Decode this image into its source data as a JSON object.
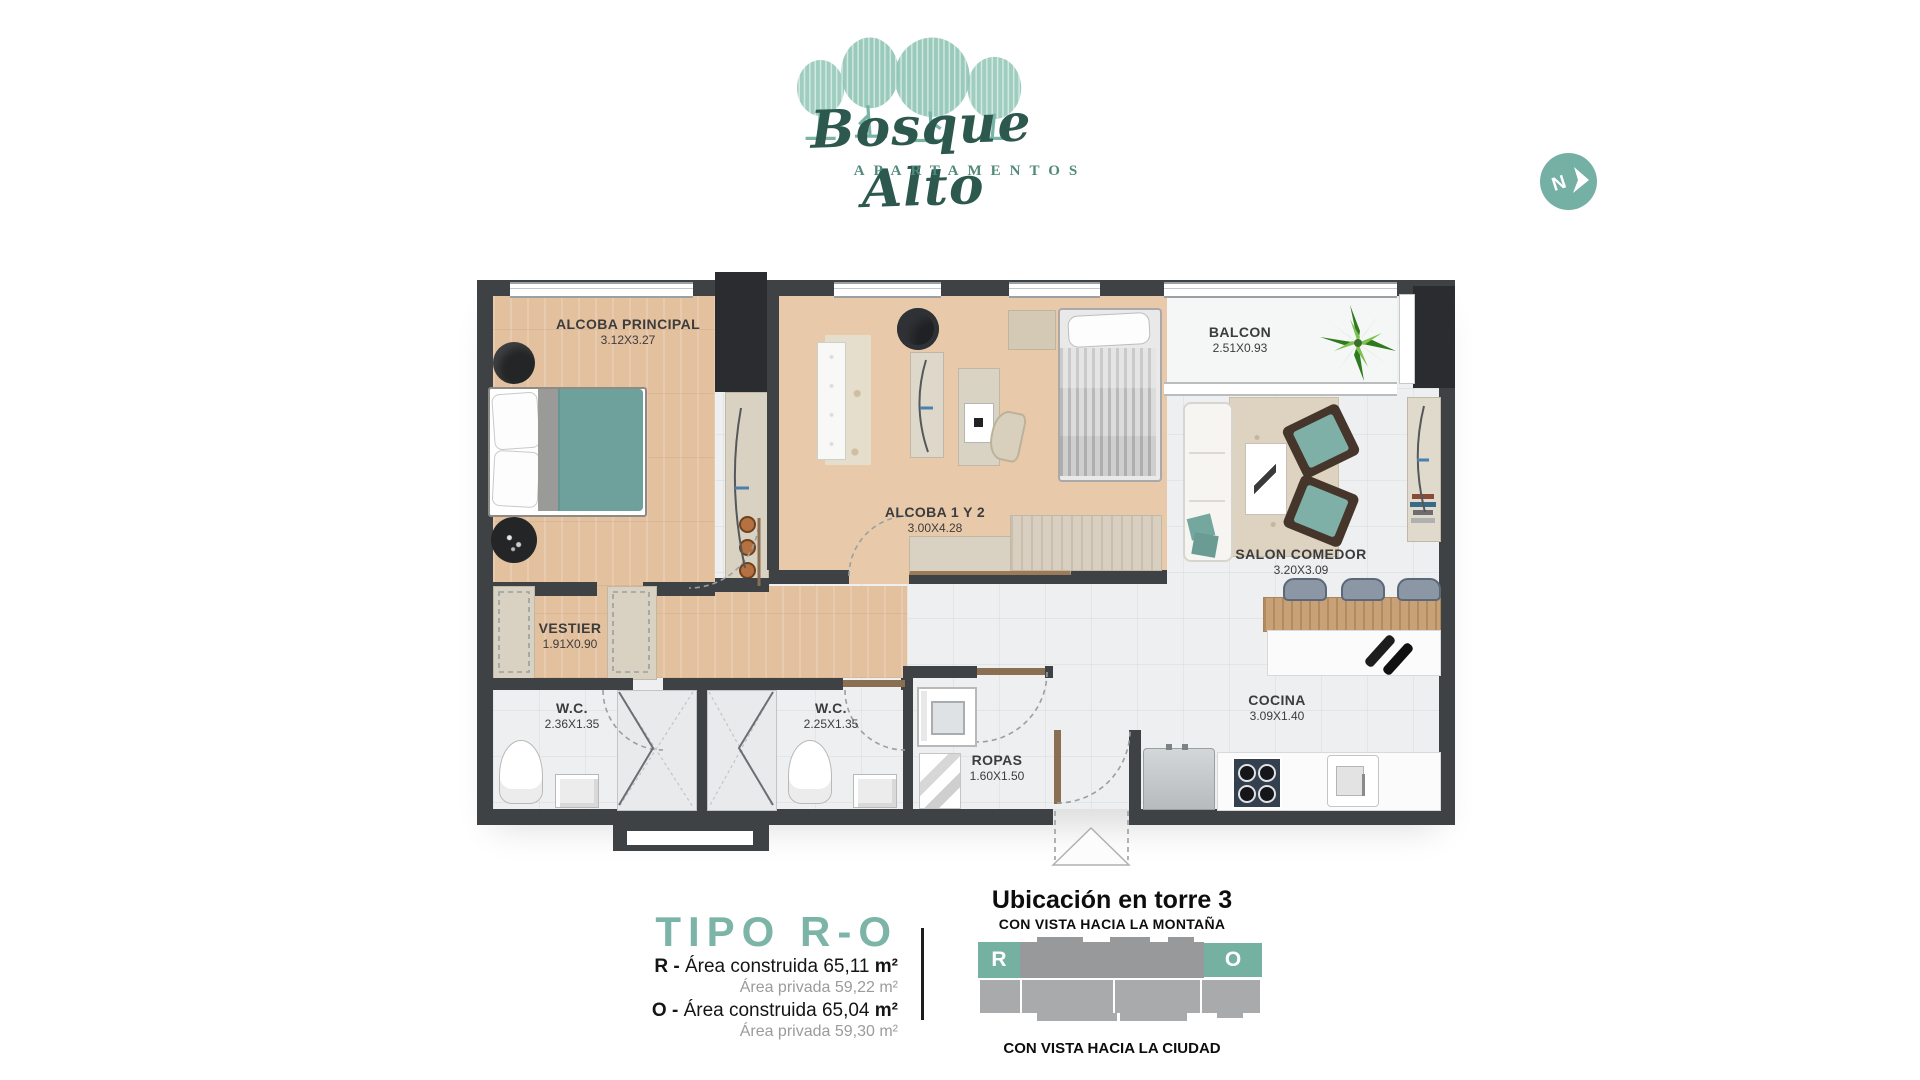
{
  "logo": {
    "title": "Bosque Alto",
    "subtitle": "APARTAMENTOS"
  },
  "compass": {
    "label": "N"
  },
  "plan": {
    "rooms": [
      {
        "name": "ALCOBA PRINCIPAL",
        "dims": "3.12X3.27"
      },
      {
        "name": "ALCOBA 1 Y 2",
        "dims": "3.00X4.28"
      },
      {
        "name": "BALCON",
        "dims": "2.51X0.93"
      },
      {
        "name": "SALON COMEDOR",
        "dims": "3.20X3.09"
      },
      {
        "name": "VESTIER",
        "dims": "1.91X0.90"
      },
      {
        "name": "W.C.",
        "dims": "2.36X1.35"
      },
      {
        "name": "W.C.",
        "dims": "2.25X1.35"
      },
      {
        "name": "ROPAS",
        "dims": "1.60X1.50"
      },
      {
        "name": "COCINA",
        "dims": "3.09X1.40"
      }
    ]
  },
  "info": {
    "type_label": "TIPO R-O",
    "areas": [
      {
        "prefix": "R - ",
        "label": "Área construida ",
        "value": "65,11 ",
        "unit": "m²",
        "sub": "Área privada 59,22 m²"
      },
      {
        "prefix": "O - ",
        "label": "Área construida ",
        "value": "65,04 ",
        "unit": "m²",
        "sub": "Área privada 59,30 m²"
      }
    ]
  },
  "location": {
    "title": "Ubicación en torre 3",
    "subtitle": "CON VISTA HACIA LA MONTAÑA",
    "caption": "CON VISTA HACIA LA CIUDAD",
    "unit_left": "R",
    "unit_right": "O"
  },
  "colors": {
    "accent": "#7cb5a8",
    "logo_green": "#2c584d",
    "compass_teal": "#74b0a4",
    "wall": "#3e4245",
    "wood": "#e3c09e",
    "tile": "#edeff0",
    "furniture_teal": "#74a8a0",
    "tower_gray": "#97999b"
  }
}
